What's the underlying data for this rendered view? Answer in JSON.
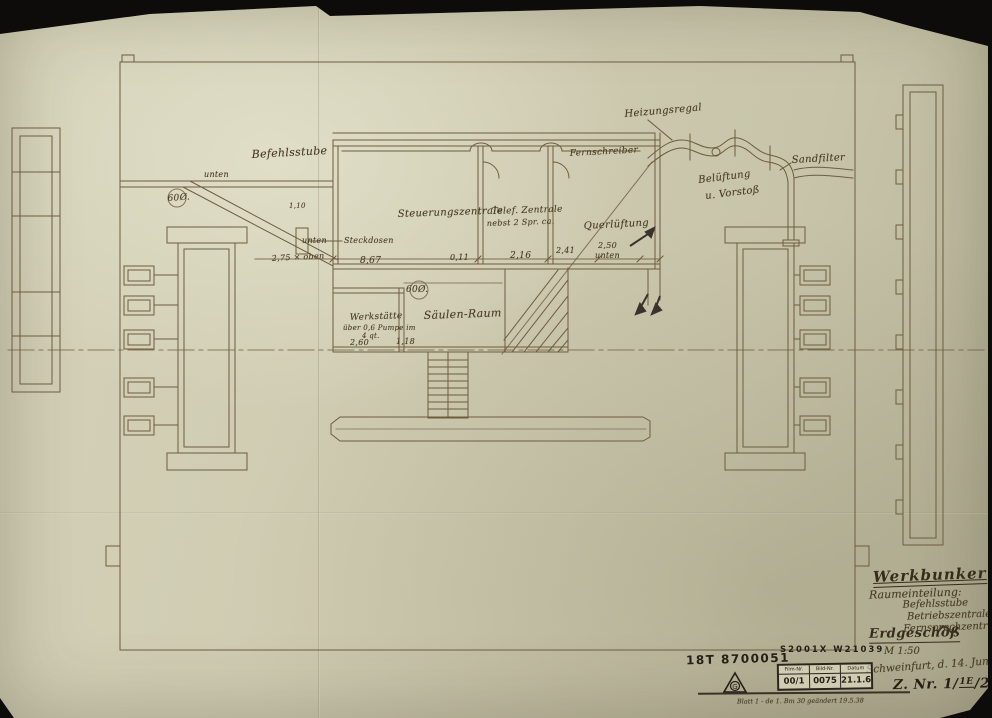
{
  "photo": {
    "background": "#0d0c0a",
    "paper_color": "#cfccb2",
    "ink_color": "#6e5c3e",
    "hand_color": "#4a3c26",
    "stamp_color": "#241f17"
  },
  "title_block": {
    "project": "Werkbunker",
    "section_label": "Raumeinteilung:",
    "rooms": [
      "Befehlsstube",
      "Betriebszentrale",
      "Fernsprechzentrale"
    ],
    "floor": "Erdgeschoß",
    "scale": "M 1:50",
    "place_date": "Schweinfurt, d. 14. Juni 44",
    "drawing_no_prefix": "Z. Nr. 1/",
    "drawing_no_revision": "1E",
    "drawing_no_suffix": "/2466"
  },
  "stamps": {
    "inventory_no": "18T 8700051",
    "film_code": "S2001X W21039",
    "mark_letter": "G",
    "film_table": {
      "headers": [
        "Film-Nr.",
        "Bild-Nr.",
        "Datum"
      ],
      "values": [
        "00/1",
        "0075",
        "21.1.64"
      ]
    },
    "revision_note": "Blatt 1 - de 1. Bm 30  geändert 19.5.38"
  },
  "plan_labels": [
    {
      "id": "label-befehlsstube",
      "text": "Befehlsstube",
      "x": 252,
      "y": 148,
      "size": 11,
      "rot": -3
    },
    {
      "id": "label-unten-left",
      "text": "unten",
      "x": 204,
      "y": 170,
      "size": 8,
      "rot": 0
    },
    {
      "id": "label-60-left",
      "text": "60Ø.",
      "x": 168,
      "y": 194,
      "size": 9,
      "rot": -4
    },
    {
      "id": "label-heizungsregal",
      "text": "Heizungsregal",
      "x": 625,
      "y": 109,
      "size": 10,
      "rot": -5
    },
    {
      "id": "label-sandfilter",
      "text": "Sandfilter",
      "x": 792,
      "y": 155,
      "size": 10,
      "rot": -3
    },
    {
      "id": "label-belueftung",
      "text": "Belüftung",
      "x": 699,
      "y": 175,
      "size": 10,
      "rot": -7
    },
    {
      "id": "label-belueftung-2",
      "text": "u. Vorstoß",
      "x": 706,
      "y": 191,
      "size": 10,
      "rot": -7
    },
    {
      "id": "label-fernschreiber",
      "text": "Fernschreiber",
      "x": 570,
      "y": 149,
      "size": 9,
      "rot": -3
    },
    {
      "id": "label-steuerungszentrale",
      "text": "Steuerungszentrale",
      "x": 398,
      "y": 209,
      "size": 10,
      "rot": -2
    },
    {
      "id": "label-telef-zentrale",
      "text": "Telef. Zentrale",
      "x": 492,
      "y": 207,
      "size": 9,
      "rot": -2
    },
    {
      "id": "label-telef-zentrale-2",
      "text": "nebst 2 Spr. ca.",
      "x": 487,
      "y": 219,
      "size": 8,
      "rot": -2
    },
    {
      "id": "label-querlueftung",
      "text": "Querlüftung",
      "x": 584,
      "y": 221,
      "size": 10,
      "rot": -3
    },
    {
      "id": "label-250",
      "text": "2,50",
      "x": 598,
      "y": 241,
      "size": 8,
      "rot": 0
    },
    {
      "id": "label-250-unten",
      "text": "unten",
      "x": 595,
      "y": 251,
      "size": 8,
      "rot": 0
    },
    {
      "id": "label-unten-mid",
      "text": "unten",
      "x": 302,
      "y": 236,
      "size": 8,
      "rot": 0
    },
    {
      "id": "label-steckdosen",
      "text": "Steckdosen",
      "x": 344,
      "y": 236,
      "size": 8,
      "rot": 0
    },
    {
      "id": "label-275-oben",
      "text": "2,75 × oben",
      "x": 272,
      "y": 254,
      "size": 8,
      "rot": -3
    },
    {
      "id": "label-110",
      "text": "1,10",
      "x": 289,
      "y": 202,
      "size": 7,
      "rot": 0
    },
    {
      "id": "label-867",
      "text": "8,67",
      "x": 360,
      "y": 256,
      "size": 9,
      "rot": 0
    },
    {
      "id": "label-011",
      "text": "0,11",
      "x": 450,
      "y": 253,
      "size": 8,
      "rot": 0
    },
    {
      "id": "label-216",
      "text": "2,16",
      "x": 510,
      "y": 251,
      "size": 9,
      "rot": 0
    },
    {
      "id": "label-241",
      "text": "2,41",
      "x": 556,
      "y": 246,
      "size": 8,
      "rot": 0
    },
    {
      "id": "label-60-mid",
      "text": "60Ø.",
      "x": 406,
      "y": 285,
      "size": 9,
      "rot": 0
    },
    {
      "id": "label-saeulen-raum",
      "text": "Säulen-Raum",
      "x": 424,
      "y": 309,
      "size": 11,
      "rot": -2
    },
    {
      "id": "label-werkstaette",
      "text": "Werkstätte",
      "x": 350,
      "y": 313,
      "size": 9,
      "rot": -2
    },
    {
      "id": "label-werkstaette-2",
      "text": "über 0,6 Pumpe im",
      "x": 343,
      "y": 324,
      "size": 7,
      "rot": 0
    },
    {
      "id": "label-werkstaette-3",
      "text": "4 qt.",
      "x": 362,
      "y": 332,
      "size": 7,
      "rot": 0
    },
    {
      "id": "label-260",
      "text": "2,60",
      "x": 350,
      "y": 338,
      "size": 8,
      "rot": 0
    },
    {
      "id": "label-118",
      "text": "1,18",
      "x": 396,
      "y": 337,
      "size": 8,
      "rot": 0
    }
  ]
}
